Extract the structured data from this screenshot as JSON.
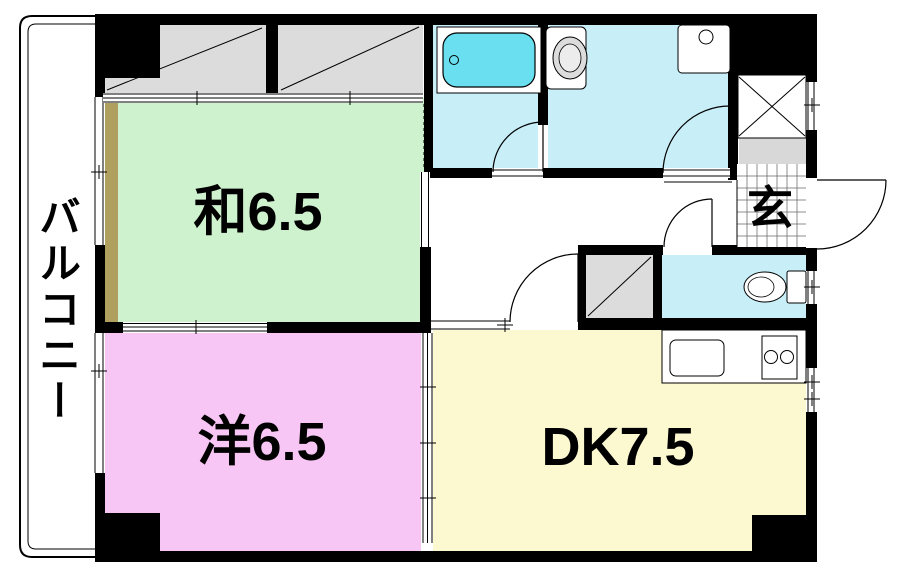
{
  "floorplan": {
    "balcony": {
      "label": "バルコニー"
    },
    "rooms": {
      "japanese_room": {
        "label": "和6.5"
      },
      "western_room": {
        "label": "洋6.5"
      },
      "dining_kitchen": {
        "label": "DK7.5"
      },
      "entrance": {
        "label": "玄"
      }
    },
    "fixtures": {
      "bathtub": "bathtub-icon",
      "toilet_main": "toilet-icon",
      "washbasin": "washbasin-icon",
      "toilet_second": "toilet-icon",
      "kitchen_sink": "kitchen-sink-icon",
      "stove": "stove-burners-icon",
      "closet_top_left": "closet-icon",
      "closet_top_right": "closet-icon",
      "closet_hall": "closet-icon",
      "shoe_cabinet": "shoe-cabinet-icon"
    },
    "colors": {
      "japanese_room": "#cdf2cd",
      "western_room": "#f8c6f4",
      "dining_kitchen": "#fcf8d0",
      "wet_room_floor": "#c8eef8",
      "bathtub": "#6adfef",
      "closet": "#dcdcdc",
      "step": "#d8d8d8",
      "tatami_edge": "#b0a060",
      "wall": "#000000"
    }
  }
}
